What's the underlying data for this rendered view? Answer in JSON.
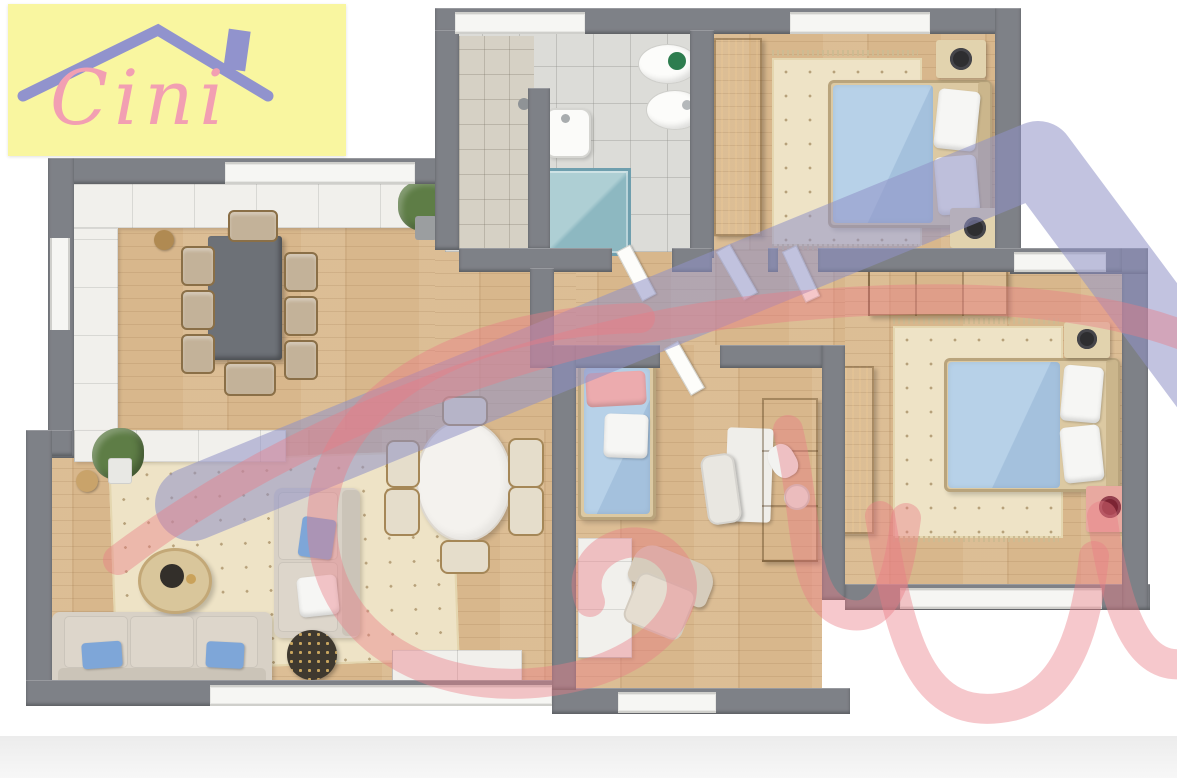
{
  "title": "3D apartment floor plan render",
  "logo": {
    "text": "Cini",
    "background": "#f8f59b",
    "script_color": "#f29fb2",
    "roof_color": "#9193cd"
  },
  "watermark": {
    "script_color": "#ea7b86",
    "roof_color": "#8f92c7",
    "script_opacity": 0.42,
    "roof_opacity": 0.55,
    "description": "giant-semi-transparent-copy-of-cini-logo"
  },
  "palette": {
    "wall": "#7e8187",
    "wood": "#d8b78c",
    "tile": "#dcdcd8",
    "tile_beige": "#d6d1c5",
    "rug": "#eee3c6",
    "white_furn": "#f1f0ec",
    "brown": "#ab7731",
    "brown_dark": "#96652a",
    "table_gray": "#6d7177",
    "chair": "#c3b299",
    "chair_cream": "#e5ddcb",
    "sofa": "#d8d1c6",
    "blue_bed": "#b7d1e8",
    "blue_pillow": "#7ea6d8",
    "pink_pillow": "#ecabae",
    "pink_stand": "#e8a9a0",
    "teal": "#9fc4ca",
    "lamp_black": "#2e2e30",
    "lamp_maroon": "#7c2433",
    "green": "#5e7d46",
    "window": "#f6f6f3",
    "logo_pink": "#f29fb2"
  },
  "rooms": [
    {
      "id": "dining-room",
      "furniture": [
        "dining-table",
        "eight-chairs",
        "wall-cabinets",
        "stool",
        "plant"
      ]
    },
    {
      "id": "bathroom",
      "furniture": [
        "toilet",
        "bidet",
        "wall-sink",
        "glass-shower",
        "tiled-shower-zone"
      ]
    },
    {
      "id": "bedroom-1",
      "furniture": [
        "double-bed-blue",
        "wardrobe",
        "two-nightstands",
        "black-lamps",
        "dotted-rug"
      ]
    },
    {
      "id": "bedroom-2",
      "furniture": [
        "double-bed-blue",
        "wardrobe",
        "dresser",
        "nightstand",
        "pink-nightstand",
        "maroon-lamp",
        "dotted-rug"
      ]
    },
    {
      "id": "kids-room",
      "furniture": [
        "single-bed",
        "pink-pillow",
        "desk",
        "desk-chair",
        "sideboard",
        "desk-lamp",
        "armchair",
        "white-cabinet"
      ]
    },
    {
      "id": "living-room",
      "furniture": [
        "three-seat-sofa",
        "sectional-sofa",
        "blue-cushions",
        "coffee-table",
        "speckled-side-table",
        "oval-dining-table",
        "six-chairs",
        "tv-cabinet",
        "sideboard",
        "plant",
        "dotted-rug"
      ]
    }
  ]
}
